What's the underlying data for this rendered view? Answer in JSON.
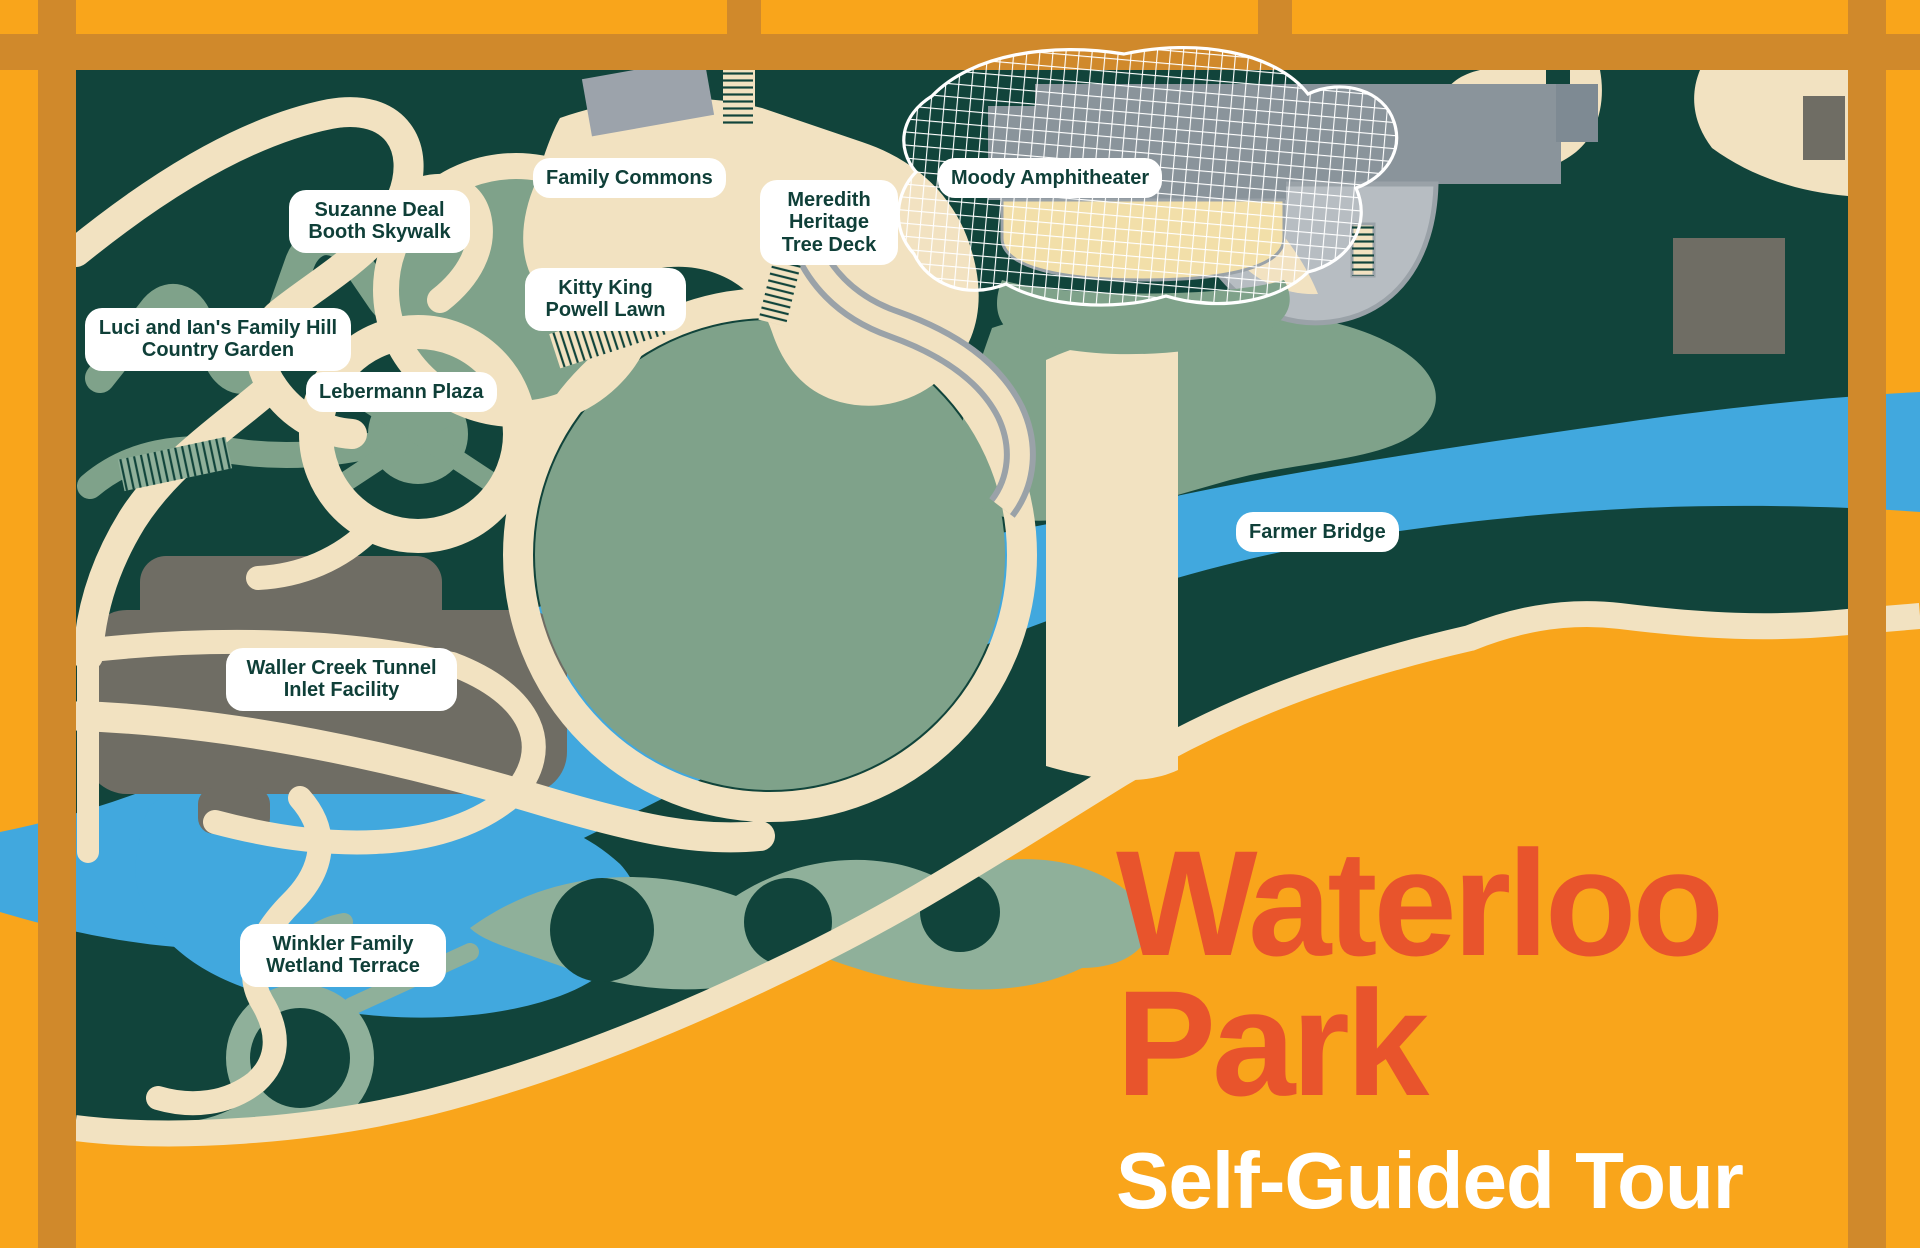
{
  "title": {
    "line1": "Waterloo",
    "line2": "Park",
    "subtitle": "Self-Guided Tour"
  },
  "labels": [
    {
      "id": "suzanne-deal-booth-skywalk",
      "text": "Suzanne Deal Booth Skywalk"
    },
    {
      "id": "family-commons",
      "text": "Family Commons"
    },
    {
      "id": "moody-amphitheater",
      "text": "Moody Amphitheater"
    },
    {
      "id": "meredith-heritage-tree-deck",
      "text": "Meredith Heritage Tree Deck"
    },
    {
      "id": "kitty-king-powell-lawn",
      "text": "Kitty King Powell Lawn"
    },
    {
      "id": "luci-and-ians-family-hill-country-garden",
      "text": "Luci and Ian's Family Hill Country Garden"
    },
    {
      "id": "lebermann-plaza",
      "text": "Lebermann Plaza"
    },
    {
      "id": "farmer-bridge",
      "text": "Farmer Bridge"
    },
    {
      "id": "waller-creek-tunnel-inlet-facility",
      "text": "Waller Creek Tunnel Inlet Facility"
    },
    {
      "id": "winkler-family-wetland-terrace",
      "text": "Winkler Family Wetland Terrace"
    }
  ],
  "palette": {
    "background_orange": "#F9A51B",
    "street_ochre": "#D0892B",
    "park_green": "#11443B",
    "creek_blue": "#41A8DE",
    "lawn_sage": "#7FA28A",
    "wetland_sage": "#8FB09A",
    "path_cream": "#F2E2C1",
    "plaza_gray": "#8A949B",
    "plaza_gray_light": "#B7BDC2",
    "edge_gray": "#9AA2A8",
    "structure_gray": "#6F6D64",
    "building_gray": "#9CA3AB",
    "building_gray_light": "#7E8A93",
    "seating_tan": "#F2DFA9",
    "mesh_white": "#FFFFFF",
    "title_orange": "#E8542C",
    "label_text_green": "#0F3F38",
    "label_bg": "#FFFFFF"
  }
}
